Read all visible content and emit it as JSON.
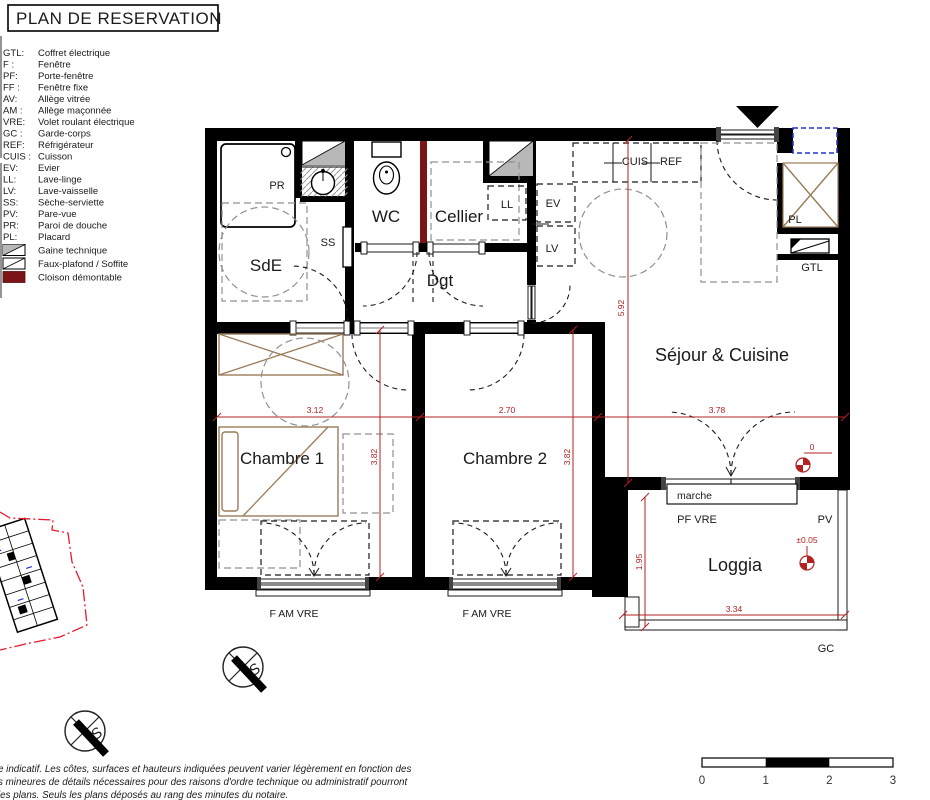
{
  "title": "PLAN DE RESERVATION",
  "legend": {
    "items": [
      {
        "abbr": "GTL:",
        "label": "Coffret électrique"
      },
      {
        "abbr": "F :",
        "label": "Fenêtre"
      },
      {
        "abbr": "PF:",
        "label": "Porte-fenêtre"
      },
      {
        "abbr": "FF :",
        "label": "Fenêtre fixe"
      },
      {
        "abbr": "AV:",
        "label": "Allège vitrée"
      },
      {
        "abbr": "AM :",
        "label": "Allège maçonnée"
      },
      {
        "abbr": "VRE:",
        "label": "Volet roulant électrique"
      },
      {
        "abbr": "GC :",
        "label": "Garde-corps"
      },
      {
        "abbr": "REF:",
        "label": "Réfrigérateur"
      },
      {
        "abbr": "CUIS :",
        "label": "Cuisson"
      },
      {
        "abbr": "EV:",
        "label": "Evier"
      },
      {
        "abbr": "LL:",
        "label": "Lave-linge"
      },
      {
        "abbr": "LV:",
        "label": "Lave-vaisselle"
      },
      {
        "abbr": "SS:",
        "label": "Sèche-serviette"
      },
      {
        "abbr": "PV:",
        "label": "Pare-vue"
      },
      {
        "abbr": "PR:",
        "label": "Paroi de douche"
      },
      {
        "abbr": "PL:",
        "label": "Placard"
      }
    ],
    "swatches": [
      {
        "label": "Gaine technique"
      },
      {
        "label": "Faux-plafond / Soffite"
      },
      {
        "label": "Cloison démontable"
      }
    ]
  },
  "rooms": {
    "sde": "SdE",
    "wc": "WC",
    "cellier": "Cellier",
    "dgt": "Dgt",
    "sejour": "Séjour & Cuisine",
    "chambre1": "Chambre 1",
    "chambre2": "Chambre 2",
    "loggia": "Loggia"
  },
  "fixtures": {
    "pr": "PR",
    "ss": "SS",
    "ll": "LL",
    "ev": "EV",
    "lv": "LV",
    "cuis": "CUIS",
    "ref": "REF",
    "pl": "PL",
    "gtl": "GTL",
    "marche": "marche",
    "pf_vre": "PF VRE",
    "pv": "PV",
    "gc": "GC",
    "f_am_vre": "F AM VRE"
  },
  "dimensions": {
    "ch1_width": "3.12",
    "ch2_width": "2.70",
    "sejour_width": "3.78",
    "ch1_depth": "3.82",
    "ch2_depth": "3.82",
    "sejour_depth": "5.92",
    "loggia_depth": "1.95",
    "loggia_width": "3.34",
    "level_zero": "0",
    "level_loggia": "±0.05"
  },
  "scale_bar": {
    "ticks": [
      "0",
      "1",
      "2",
      "3"
    ]
  },
  "compass": {
    "letter": "S"
  },
  "disclaimer": {
    "lines": [
      "e indicatif. Les côtes, surfaces et hauteurs indiquées peuvent varier légèrement en fonction des",
      "s mineures de détails nécessaires pour des raisons d'ordre technique ou administratif pourront",
      " les plans. Seuls les plans déposés au rang des minutes du notaire."
    ]
  },
  "colors": {
    "dimension_red": "#b22222",
    "cloison_red": "#7b1416",
    "furniture_brown": "#9b7c59",
    "site_boundary_red": "#e8192c",
    "vent_blue": "#2233cc",
    "gaine_gray": "#b8b8b8"
  }
}
